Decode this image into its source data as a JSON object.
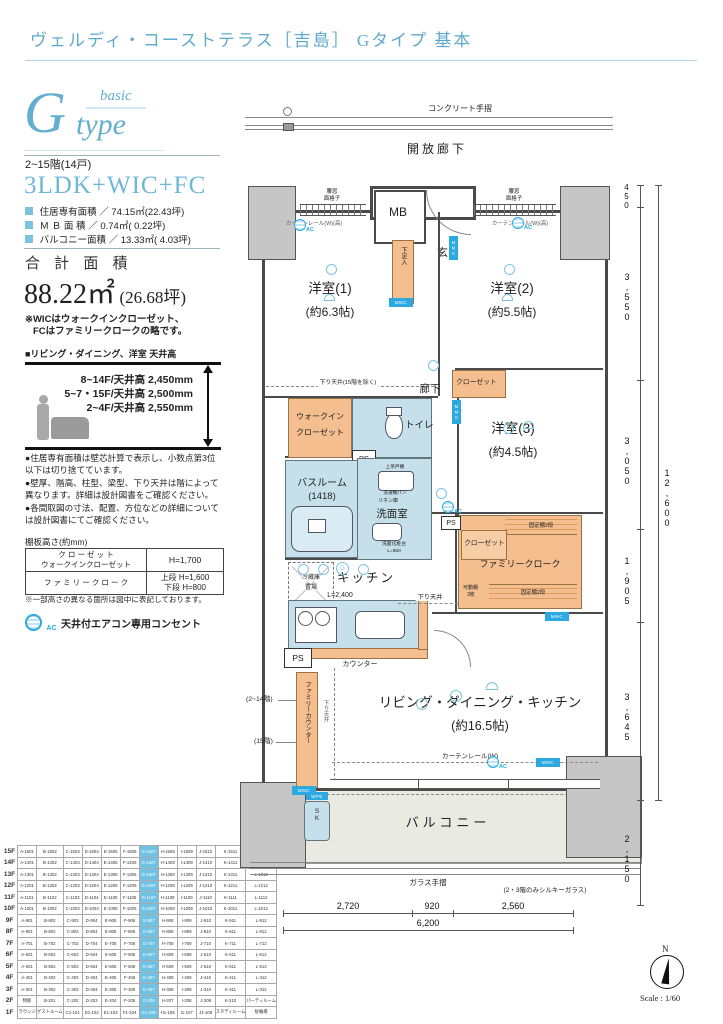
{
  "header": {
    "title": "ヴェルディ・コーストテラス［吉島］ Gタイプ 基本"
  },
  "logo": {
    "g": "G",
    "basic": "basic",
    "type": "type"
  },
  "summary": {
    "floors": "2~15階(14戸)",
    "layout": "3LDK+WIC+FC",
    "areas": [
      {
        "label": "住居専有面積 ／",
        "value": "74.15㎡(22.43坪)"
      },
      {
        "label": "Ｍ Ｂ 面 積 ／",
        "value": "0.74㎡( 0.22坪)"
      },
      {
        "label": "バルコニー面積 ／",
        "value": "13.33㎡( 4.03坪)"
      }
    ],
    "total_label": "合 計 面 積",
    "total_value": "88.22㎡",
    "total_tsubo": "(26.68坪)",
    "wic_note1": "※WICはウォークインクローゼット、",
    "wic_note2": "FCはファミリークロークの略です。"
  },
  "ceiling": {
    "heading": "■リビング・ダイニング、洋室 天井高",
    "lines": [
      "8~14F/天井高 2,450mm",
      "5~7・15F/天井高 2,500mm",
      "2~4F/天井高 2,550mm"
    ]
  },
  "notes": [
    "●住居専有面積は壁芯計算で表示し、小数点第3位以下は切り捨てています。",
    "●壁厚、階高、柱型、梁型、下り天井は階によって異なります。詳細は設計図書をご確認ください。",
    "●各間取図の寸法、配置、方位などの詳細については設計図書にてご確認ください。"
  ],
  "shelf": {
    "caption": "棚板高さ(約mm)",
    "r1l1": "ク ロ ー ゼ ッ ト",
    "r1l2": "ウォークインクローゼット",
    "r1v": "H=1,700",
    "r2l": "フ ァ ミ リ ー ク ロ ー ク",
    "r2v1": "上段 H=1,600",
    "r2v2": "下段 H=800",
    "note": "※一部高さの異なる箇所は図中に表記しております。"
  },
  "ac_legend": {
    "label": "AC",
    "text": "天井付エアコン専用コンセント"
  },
  "unit_table": {
    "highlight_index": 6,
    "rows": [
      {
        "floor": "15F",
        "cells": [
          "A-1501",
          "B-1502",
          "C-1503",
          "D-1504",
          "E-1505",
          "F-1506",
          "G-1507",
          "H-1508",
          "I-1509",
          "J-1510",
          "K-1511",
          "L-1512"
        ]
      },
      {
        "floor": "14F",
        "cells": [
          "A-1401",
          "B-1402",
          "C-1403",
          "D-1404",
          "E-1405",
          "F-1406",
          "G-1407",
          "H-1408",
          "I-1409",
          "J-1410",
          "K-1411",
          "L-1412"
        ]
      },
      {
        "floor": "13F",
        "cells": [
          "A-1301",
          "B-1302",
          "C-1303",
          "D-1304",
          "E-1305",
          "F-1306",
          "G-1307",
          "H-1308",
          "I-1309",
          "J-1310",
          "K-1311",
          "L-1312"
        ]
      },
      {
        "floor": "12F",
        "cells": [
          "A-1201",
          "B-1202",
          "C-1203",
          "D-1204",
          "E-1205",
          "F-1206",
          "G-1207",
          "H-1208",
          "I-1209",
          "J-1210",
          "K-1211",
          "L-1212"
        ]
      },
      {
        "floor": "11F",
        "cells": [
          "A-1101",
          "B-1102",
          "C-1103",
          "D-1104",
          "E-1105",
          "F-1106",
          "G-1107",
          "H-1108",
          "I-1109",
          "J-1110",
          "K-1111",
          "L-1112"
        ]
      },
      {
        "floor": "10F",
        "cells": [
          "A-1001",
          "B-1002",
          "C-1003",
          "D-1004",
          "E-1005",
          "F-1006",
          "G-1007",
          "H-1008",
          "I-1009",
          "J-1010",
          "K-1011",
          "L-1012"
        ]
      },
      {
        "floor": "9F",
        "cells": [
          "A-901",
          "B-902",
          "C-903",
          "D-904",
          "E-905",
          "F-906",
          "G-907",
          "H-908",
          "I-909",
          "J-910",
          "K-911",
          "L-912"
        ]
      },
      {
        "floor": "8F",
        "cells": [
          "A-801",
          "B-802",
          "C-803",
          "D-804",
          "E-805",
          "F-806",
          "G-807",
          "H-808",
          "I-809",
          "J-810",
          "K-811",
          "L-812"
        ]
      },
      {
        "floor": "7F",
        "cells": [
          "A-701",
          "B-702",
          "C-703",
          "D-704",
          "E-705",
          "F-706",
          "G-707",
          "H-708",
          "I-709",
          "J-710",
          "K-711",
          "L-712"
        ]
      },
      {
        "floor": "6F",
        "cells": [
          "A-601",
          "B-602",
          "C-603",
          "D-604",
          "E-605",
          "F-606",
          "G-607",
          "H-608",
          "I-609",
          "J-610",
          "K-611",
          "L-612"
        ]
      },
      {
        "floor": "5F",
        "cells": [
          "A-501",
          "B-502",
          "C-503",
          "D-504",
          "E-505",
          "F-506",
          "G-507",
          "H-508",
          "I-509",
          "J-510",
          "K-511",
          "L-512"
        ]
      },
      {
        "floor": "4F",
        "cells": [
          "A-401",
          "B-402",
          "C-403",
          "D-404",
          "E-405",
          "F-406",
          "G-407",
          "H-408",
          "I-409",
          "J-410",
          "K-411",
          "L-412"
        ]
      },
      {
        "floor": "3F",
        "cells": [
          "A-301",
          "B-302",
          "C-303",
          "D-304",
          "E-305",
          "F-306",
          "G-307",
          "H-308",
          "I-309",
          "J-310",
          "K-311",
          "L-312"
        ]
      },
      {
        "floor": "2F",
        "cells": [
          "物販",
          "B-201",
          "C-202",
          "D-203",
          "E-204",
          "F-205",
          "G-206",
          "H-207",
          "I-208",
          "J-209",
          "K-210",
          "パーティルーム"
        ]
      },
      {
        "floor": "1F",
        "cells": [
          "ラウンジ",
          "ゲストルーム",
          "C1-101",
          "D1-102",
          "E1-103",
          "F1-104",
          "G1-105",
          "H1-106",
          "I1-107",
          "J1-108",
          "スタディルーム",
          "駐輪場"
        ]
      }
    ]
  },
  "plan": {
    "concrete_rail": "コンクリート手摺",
    "open_corridor": "開放廊下",
    "mb": "MB",
    "genkan": "玄関",
    "shoe_box": "下足入",
    "koshimado": "腰窓",
    "grille": "面格子",
    "curtain_high": "カーテンレール(W)(高)",
    "room1": {
      "name": "洋室(1)",
      "size": "(約6.3帖)"
    },
    "room2": {
      "name": "洋室(2)",
      "size": "(約5.5帖)"
    },
    "room3": {
      "name": "洋室(3)",
      "size": "(約4.5帖)"
    },
    "hallway": "廊下",
    "closet": "クローゼット",
    "wic1": "ウォークイン",
    "wic2": "クローゼット",
    "toilet": "トイレ",
    "bath1": "バスルーム",
    "bath2": "(1418)",
    "washroom": "洗面室",
    "linen": "リネン庫",
    "cupboard": "上吊戸棚",
    "washer_pan": "洗濯機パン",
    "vanity1": "洗面化粧台",
    "vanity2": "L=950",
    "fridge1": "冷蔵庫",
    "fridge2": "置場",
    "kitchen": "キッチン",
    "kitchen_len": "L=2,400",
    "counter": "カウンター",
    "family_counter": "ファミリーカウンター",
    "fc_note1": "(2~14階)",
    "fc_note2": "(15階)",
    "ldk": {
      "name": "リビング・ダイニング・キッチン",
      "size": "(約16.5帖)"
    },
    "family_cloak": "ファミリークローク",
    "fixed_shelf": "固定棚2段",
    "movable1": "可動棚",
    "movable2": "3枚",
    "lowered_ceiling": "下り天井",
    "lowered_ceiling_note": "下り天井(15階を除く)",
    "curtain_rail": "カーテンレール(W)",
    "balcony": "バルコニー",
    "glass_rail": "ガラス手摺",
    "silky_glass": "(2・3階のみシルキーガラス)",
    "ps": "PS",
    "mmc": "MMC",
    "sk": "SK",
    "wpe": "WPE",
    "ac": "AC",
    "g_outlet": "G",
    "dims": {
      "bottom": [
        "2,720",
        "920",
        "2,560"
      ],
      "bottom_total": "6,200",
      "right": [
        "450",
        "3,550",
        "3,050",
        "1,905",
        "3,645"
      ],
      "right_total": "12,600",
      "right_low": "2,150"
    },
    "compass_n": "N",
    "scale": "Scale : 1/60"
  }
}
